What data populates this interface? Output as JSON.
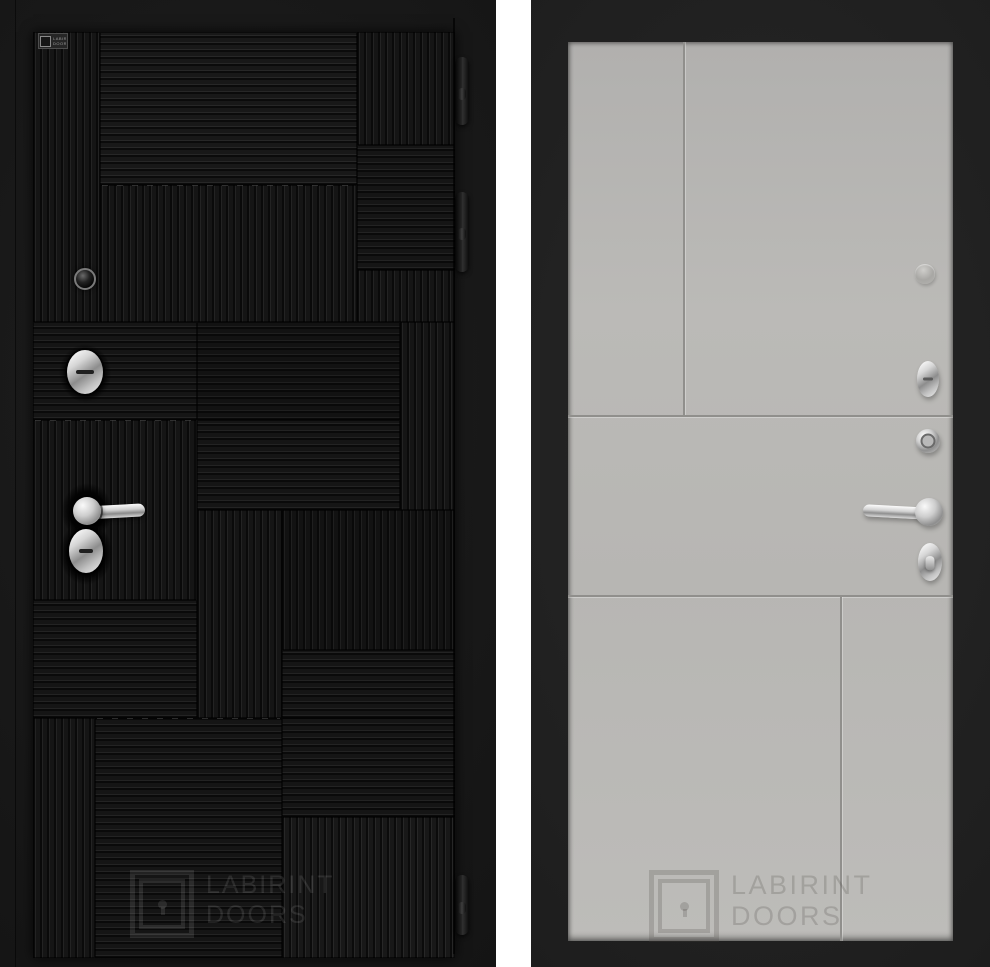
{
  "page": {
    "background_color": "#ffffff"
  },
  "left_door": {
    "description": "black entry door with ribbed patchwork pattern, exterior side",
    "colors": {
      "frame": "#161616",
      "leaf_base": "#151515",
      "rib_dark": "#0a0a0a",
      "rib_light": "#232323"
    },
    "brand_plate": {
      "line1": "LABIRINT",
      "line2": "DOORS"
    },
    "watermark": {
      "line1": "LABIRINT",
      "line2": "DOORS",
      "color": "rgba(255,255,255,0.10)"
    }
  },
  "right_door": {
    "description": "light grey interior side of entry door with grooved panels",
    "colors": {
      "frame": "#202020",
      "panel": "#b7b6b3",
      "groove": "#908f8c"
    },
    "watermark": {
      "line1": "LABIRINT",
      "line2": "DOORS",
      "color": "rgba(72,70,66,0.22)"
    }
  }
}
